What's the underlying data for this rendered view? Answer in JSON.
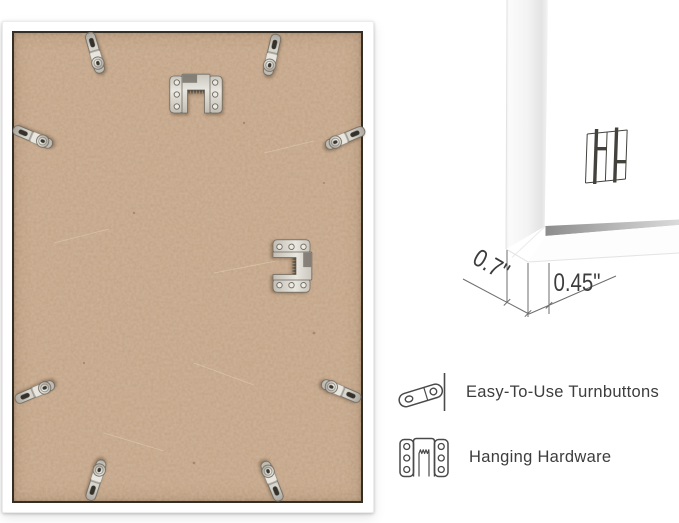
{
  "back_panel": {
    "frame_color": "#ffffff",
    "backing_color": "#c3a285",
    "turnbutton_count": 8,
    "sawtooth_hanger_count": 2
  },
  "profile": {
    "depth_label": "0.7\"",
    "face_label": "0.45\"",
    "logo": "double-H monogram"
  },
  "features": [
    {
      "icon": "turnbutton-icon",
      "label": "Easy-To-Use Turnbuttons"
    },
    {
      "icon": "hanging-hardware-icon",
      "label": "Hanging Hardware"
    }
  ],
  "colors": {
    "dimension_text": "#3c3c3c",
    "dimension_line": "#6e6e6e",
    "feature_text": "#3d3d3d"
  }
}
